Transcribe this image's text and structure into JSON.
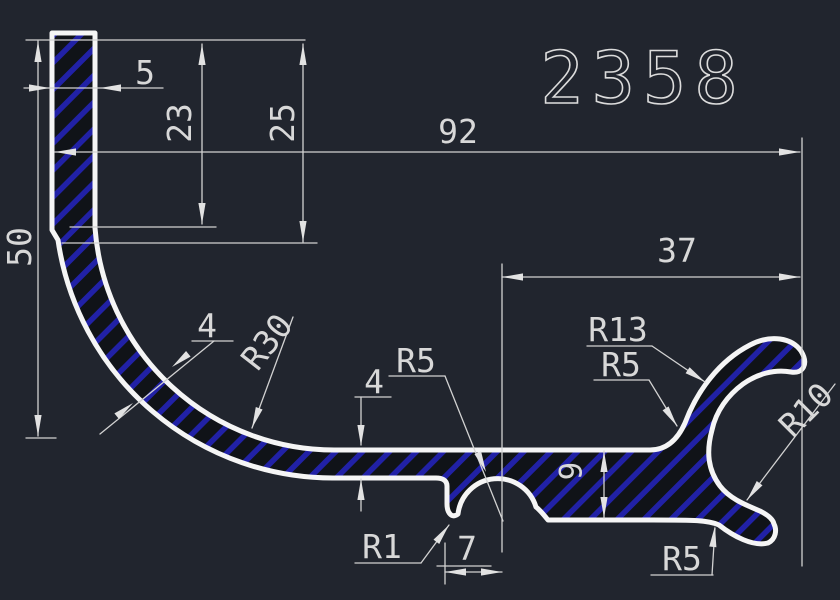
{
  "title": "2358",
  "colors": {
    "background": "#21252e",
    "outline": "#f5f5f5",
    "dimension_lines": "#d2d2d2",
    "dimension_text": "#d8d8d8",
    "hatch_stripe": "#2121a6",
    "material_base": "#101318"
  },
  "dims": {
    "total_height": "50",
    "top_width": "5",
    "upper_height": "23",
    "upper_outer_height": "25",
    "total_width": "92",
    "right_width": "37",
    "bend_wall": "4",
    "bend_radius": "R30",
    "arm_wall": "4",
    "notch_radius": "R5",
    "arm_height": "9",
    "hook_radius_outer": "R13",
    "hook_fillet_radius": "R5",
    "hook_radius_inner": "R10",
    "step_radius": "R1",
    "notch_width": "7",
    "bottom_radius": "R5"
  }
}
